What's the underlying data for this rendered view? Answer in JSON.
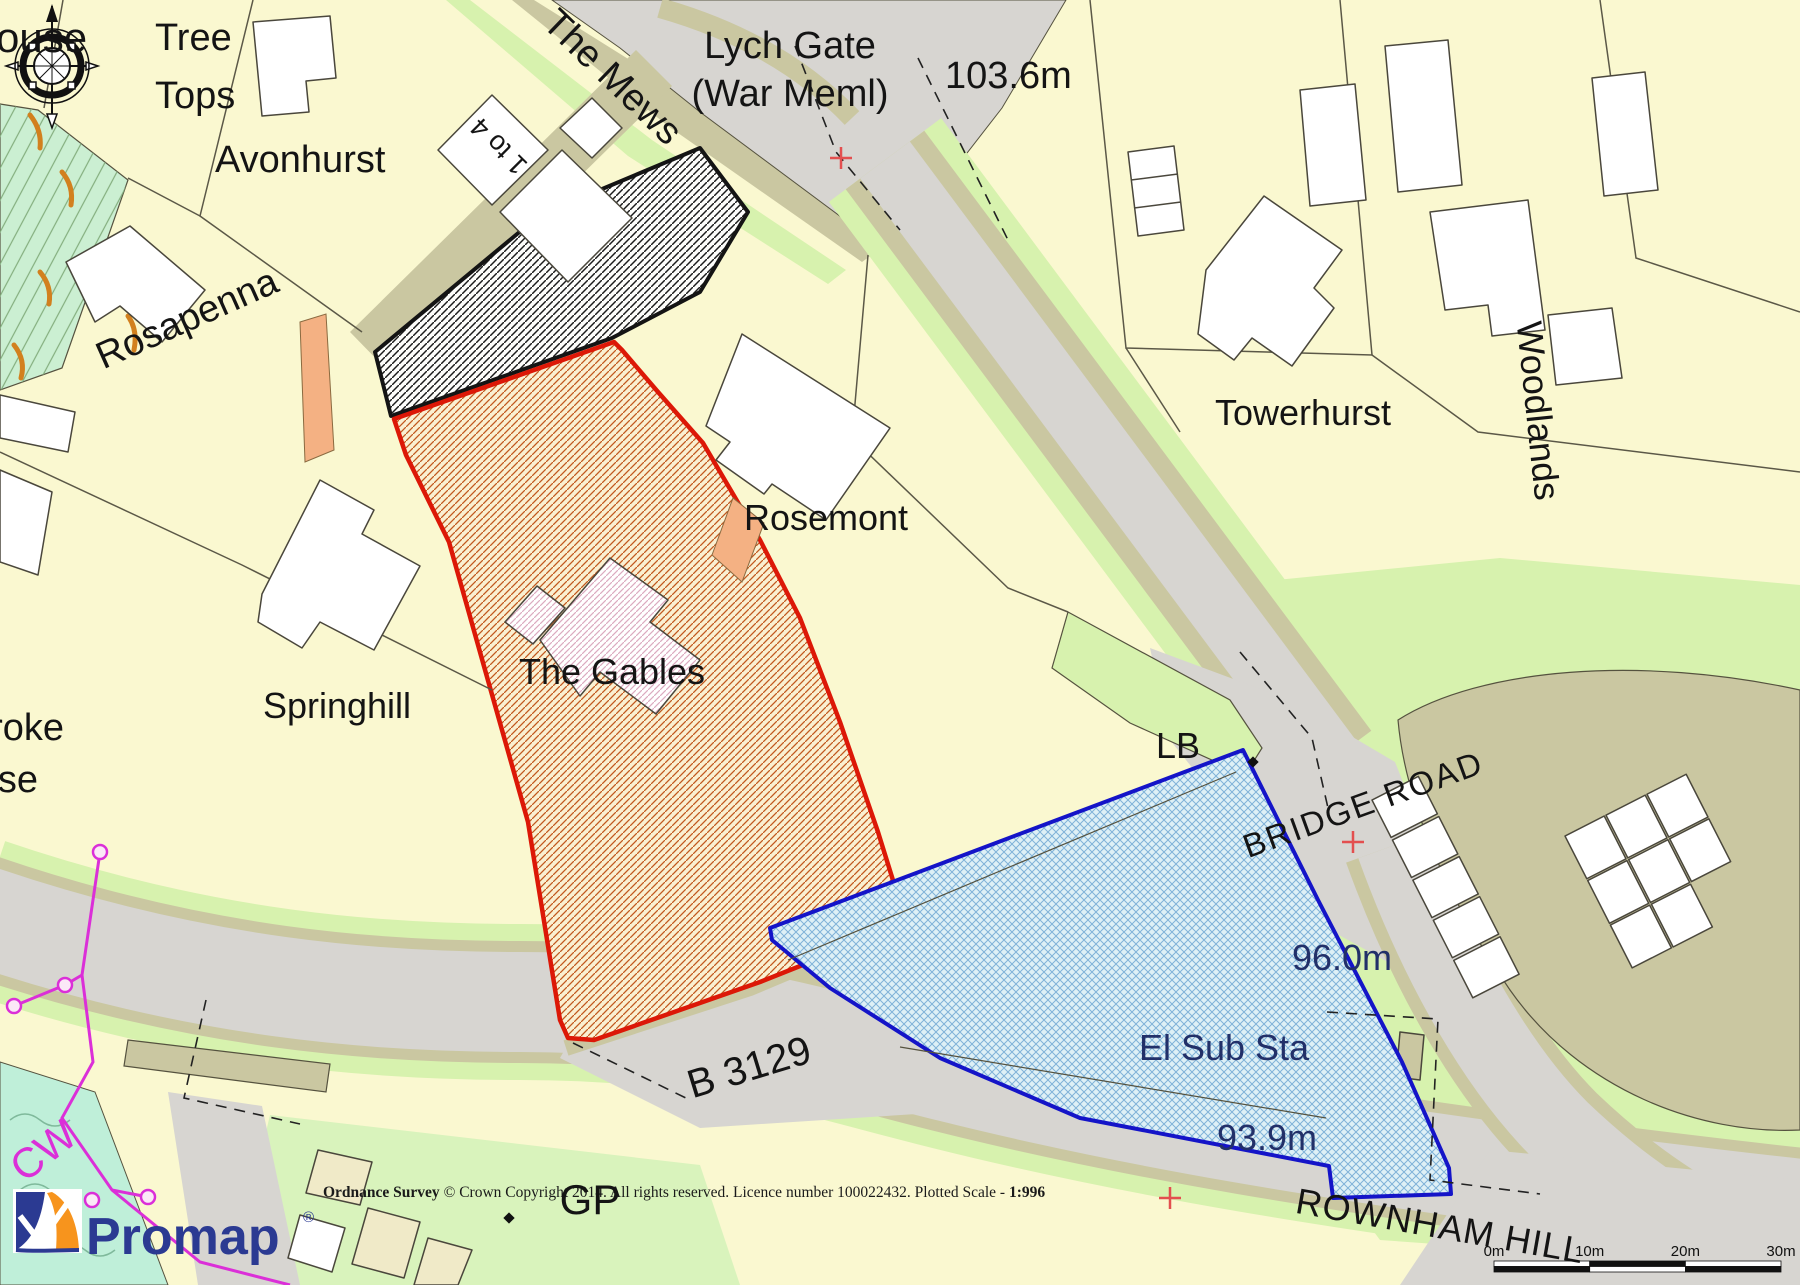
{
  "map": {
    "title": "Promap Ordnance Survey plan",
    "labels": [
      {
        "id": "house-partial",
        "text": "ouse",
        "x": -4,
        "y": 52,
        "size": 42,
        "anchor": "start"
      },
      {
        "id": "tree-tops-line1",
        "text": "Tree",
        "x": 155,
        "y": 50,
        "size": 38,
        "anchor": "start"
      },
      {
        "id": "tree-tops-line2",
        "text": "Tops",
        "x": 155,
        "y": 108,
        "size": 38,
        "anchor": "start"
      },
      {
        "id": "avonhurst",
        "text": "Avonhurst",
        "x": 215,
        "y": 172,
        "size": 38,
        "anchor": "start"
      },
      {
        "id": "the-mews",
        "text": "The Mews",
        "x": 604,
        "y": 86,
        "size": 38,
        "rotate": 44
      },
      {
        "id": "one-to-four",
        "text": "1 to 4",
        "x": 505,
        "y": 140,
        "size": 27,
        "rotate": 225
      },
      {
        "id": "lych-gate-line1",
        "text": "Lych Gate",
        "x": 790,
        "y": 58,
        "size": 38
      },
      {
        "id": "lych-gate-line2",
        "text": "(War Meml)",
        "x": 790,
        "y": 106,
        "size": 38
      },
      {
        "id": "spot-height-1036",
        "text": "103.6m",
        "x": 945,
        "y": 88,
        "size": 38,
        "anchor": "start"
      },
      {
        "id": "rosapenna",
        "text": "Rosapenna",
        "x": 192,
        "y": 330,
        "size": 38,
        "rotate": -24
      },
      {
        "id": "towerhurst",
        "text": "Towerhurst",
        "x": 1303,
        "y": 425,
        "size": 36
      },
      {
        "id": "woodlands",
        "text": "Woodlands",
        "x": 1526,
        "y": 412,
        "size": 36,
        "rotate": 84
      },
      {
        "id": "rosemont",
        "text": "Rosemont",
        "x": 826,
        "y": 530,
        "size": 36
      },
      {
        "id": "the-gables",
        "text": "The Gables",
        "x": 612,
        "y": 684,
        "size": 36
      },
      {
        "id": "springhill",
        "text": "Springhill",
        "x": 337,
        "y": 718,
        "size": 36
      },
      {
        "id": "broke-partial",
        "text": "roke",
        "x": 64,
        "y": 740,
        "size": 38,
        "anchor": "end"
      },
      {
        "id": "se-partial",
        "text": "se",
        "x": 38,
        "y": 792,
        "size": 38,
        "anchor": "end"
      },
      {
        "id": "lb",
        "text": "LB",
        "x": 1178,
        "y": 758,
        "size": 36
      },
      {
        "id": "bridge-road",
        "text": "BRIDGE ROAD",
        "x": 1367,
        "y": 815,
        "size": 33,
        "rotate": -20,
        "spacing": 2
      },
      {
        "id": "b-3129",
        "text": "B 3129",
        "x": 753,
        "y": 1080,
        "size": 40,
        "rotate": -17
      },
      {
        "id": "spot-height-960",
        "text": "96.0m",
        "x": 1342,
        "y": 970,
        "size": 36,
        "color": "#223069"
      },
      {
        "id": "el-sub-sta",
        "text": "El Sub Sta",
        "x": 1224,
        "y": 1060,
        "size": 36,
        "color": "#223069"
      },
      {
        "id": "spot-height-939",
        "text": "93.9m",
        "x": 1267,
        "y": 1150,
        "size": 36,
        "color": "#223069"
      },
      {
        "id": "rownham-hill",
        "text": "ROWNHAM HILL",
        "x": 1438,
        "y": 1238,
        "size": 36,
        "rotate": 10,
        "spacing": 1
      },
      {
        "id": "gp",
        "text": "GP",
        "x": 590,
        "y": 1214,
        "size": 42
      },
      {
        "id": "cw",
        "text": "CW",
        "x": 52,
        "y": 1162,
        "size": 42,
        "rotate": -38,
        "color": "#DB2FD8"
      }
    ],
    "copyright": {
      "parts": [
        {
          "text": "Ordnance Survey",
          "bold": true
        },
        {
          "text": " © Crown Copyright 2014. All rights reserved. Licence number 100022432. Plotted Scale - ",
          "bold": false
        },
        {
          "text": "1:996",
          "bold": true
        }
      ]
    },
    "scale_bar": {
      "labels": [
        "0m",
        "10m",
        "20m",
        "30m"
      ]
    },
    "logo": {
      "text": "Promap",
      "registered": "®"
    },
    "colors": {
      "background": "#FAF8D0",
      "road": "#D7D5D1",
      "verge": "#D7F2AE",
      "mint": "#D9F3BC",
      "teal": "#BFEFD9",
      "khaki": "#CAC7A1",
      "slope_green": "#CBEFD2",
      "building": "#FFFFFF",
      "outline": "#55523F",
      "label": "#141414",
      "navy_label": "#223069",
      "site_boundary_red": "#DC1807",
      "site_hatch_orange": "#C2591F",
      "blue_boundary": "#1414C8",
      "blue_fill": "#DEF0F6",
      "blue_hatch": "#7FB2D8",
      "boundary_magenta": "#DB2FD8",
      "drive_orange": "#F4B183",
      "grid_cross_red": "#E34F4F",
      "promap_blue": "#2B3A92",
      "promap_orange": "#F7941D"
    }
  }
}
